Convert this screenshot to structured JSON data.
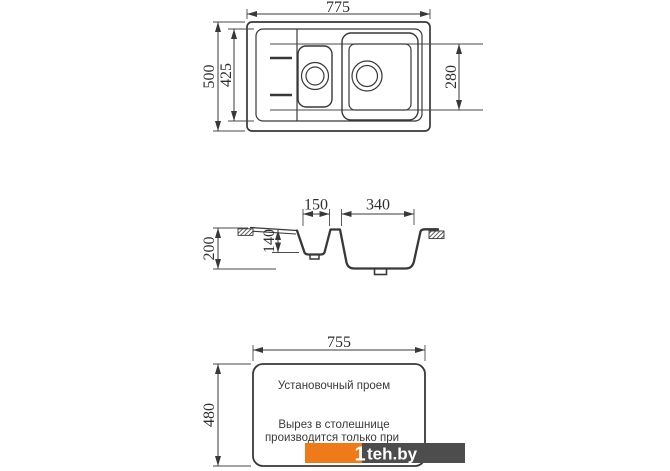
{
  "drawing": {
    "top_view": {
      "width_label": "775",
      "outer_depth_label": "500",
      "inner_depth_label": "425",
      "main_bowl_depth_label": "280"
    },
    "section_view": {
      "small_bowl_width_label": "150",
      "main_bowl_width_label": "340",
      "total_depth_label": "200",
      "small_bowl_depth_label": "140"
    },
    "cutout_view": {
      "width_label": "755",
      "height_label": "480",
      "title": "Установочный проем",
      "note_line1": "Вырез в столешнице",
      "note_line2": "производится только при"
    }
  },
  "watermark": {
    "logo_one": "1",
    "site": "teh.by",
    "bar_color": "#4d4d4d",
    "accent_color": "#ef7a1a"
  },
  "colors": {
    "line": "#383838",
    "background": "#ffffff"
  }
}
